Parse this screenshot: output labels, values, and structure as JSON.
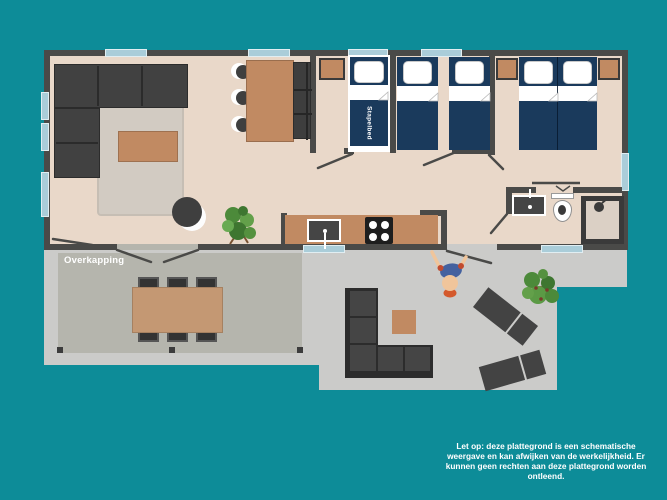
{
  "labels": {
    "overkapping": "Overkapping",
    "stapelbed": "Stapelbed"
  },
  "disclaimer_lines": [
    "Let op: deze plattegrond is een schematische",
    "weergave en kan afwijken van de werkelijkheid. Er",
    "kunnen geen rechten aan deze plattegrond worden",
    "ontleend."
  ],
  "colors": {
    "teal": "#0d8c98",
    "wall": "#4a4a48",
    "floor": "#e9d8c9",
    "terrace": "#cbcbc9",
    "covered": "#b5b5ad",
    "wood": "#c18a62",
    "woodLight": "#c49873",
    "navy": "#1a3a5c",
    "windowBlue": "#aacdd9",
    "darkFurn": "#3f3f3f",
    "cushion": "#454545",
    "rug": "#d2cbc2",
    "skin": "#f0c59b",
    "personBlue": "#44619f",
    "accentRed": "#c24b2e",
    "waistOrange": "#d4592c",
    "green1": "#4c8a3a",
    "green2": "#63a04a",
    "green3": "#3e7630",
    "potBrown": "#8a5a3b"
  }
}
